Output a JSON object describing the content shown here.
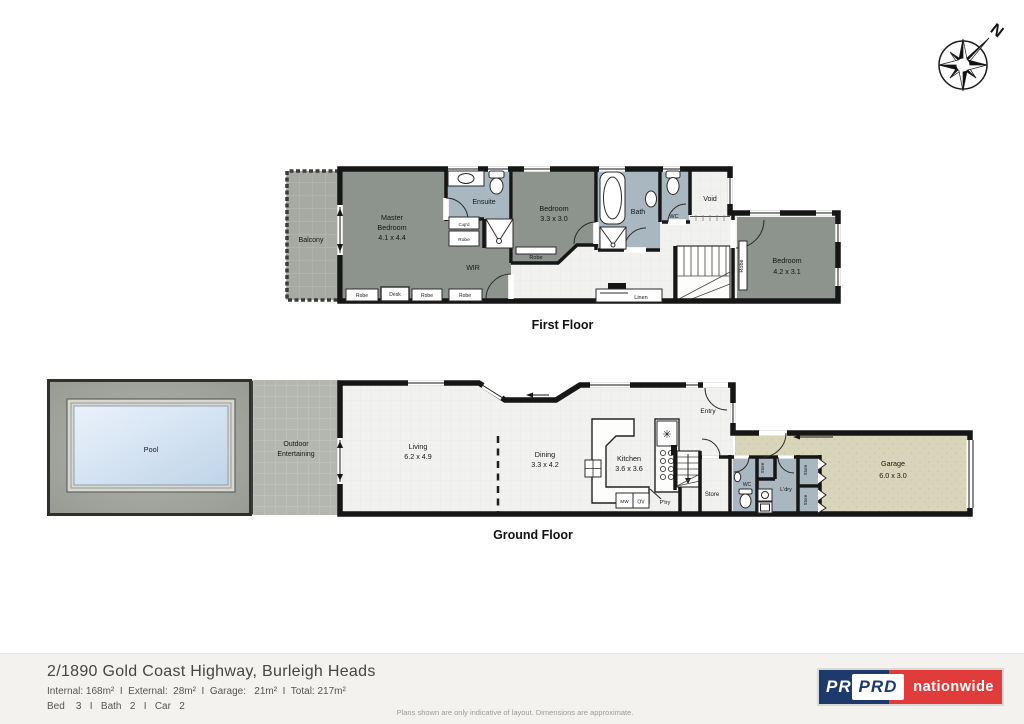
{
  "compass": {
    "north_label": "N"
  },
  "first_floor": {
    "caption": "First Floor",
    "labels": {
      "balcony": "Balcony",
      "master_line1": "Master",
      "master_line2": "Bedroom",
      "master_dims": "4.1 x 4.4",
      "ensuite": "Ensuite",
      "cupd": "Cup'd",
      "robe": "Robe",
      "wir": "WIR",
      "desk": "Desk",
      "bedroom2_name": "Bedroom",
      "bedroom2_dims": "3.3 x 3.0",
      "bath": "Bath",
      "wc": "WC",
      "void": "Void",
      "linen": "Linen",
      "bedroom3_name": "Bedroom",
      "bedroom3_dims": "4.2 x 3.1"
    }
  },
  "ground_floor": {
    "caption": "Ground Floor",
    "labels": {
      "pool": "Pool",
      "outdoor_line1": "Outdoor",
      "outdoor_line2": "Entertaining",
      "living_name": "Living",
      "living_dims": "6.2 x 4.9",
      "dining_name": "Dining",
      "dining_dims": "3.3 x 4.2",
      "kitchen_name": "Kitchen",
      "kitchen_dims": "3.6 x 3.6",
      "cooktop_symbol": "✳",
      "mw": "MW",
      "ov": "OV",
      "pantry": "P'try",
      "entry": "Entry",
      "store": "Store",
      "wc": "WC",
      "ldry": "L'dry",
      "garage_name": "Garage",
      "garage_dims": "6.0 x 3.0"
    }
  },
  "footer": {
    "address": "2/1890 Gold Coast Highway, Burleigh Heads",
    "areas_line": "Internal: 168m²  I  External:  28m²  I  Garage:   21m²  I  Total: 217m²",
    "rooms_line": "Bed    3   I   Bath   2   I   Car   2",
    "disclaimer": "Plans shown are only indicative of layout. Dimensions are approximate.",
    "logo": {
      "navy_text": "PRD",
      "box_text": "PRD",
      "brand_text": "nationwide"
    }
  },
  "colors": {
    "wall": "#161616",
    "bedroom_fill": "#8d938d",
    "wet_area_fill": "#a9b7c0",
    "garage_fill": "#d9d5bb",
    "pool_water": "#cfe0f2",
    "outdoor_fill": "#b4b7b0",
    "deck_fill": "#a2a59c",
    "floor_fill": "#f1f1ef",
    "footer_bg": "#f3f2ef",
    "logo_navy": "#1e3a6d",
    "logo_red": "#e03c3c"
  }
}
